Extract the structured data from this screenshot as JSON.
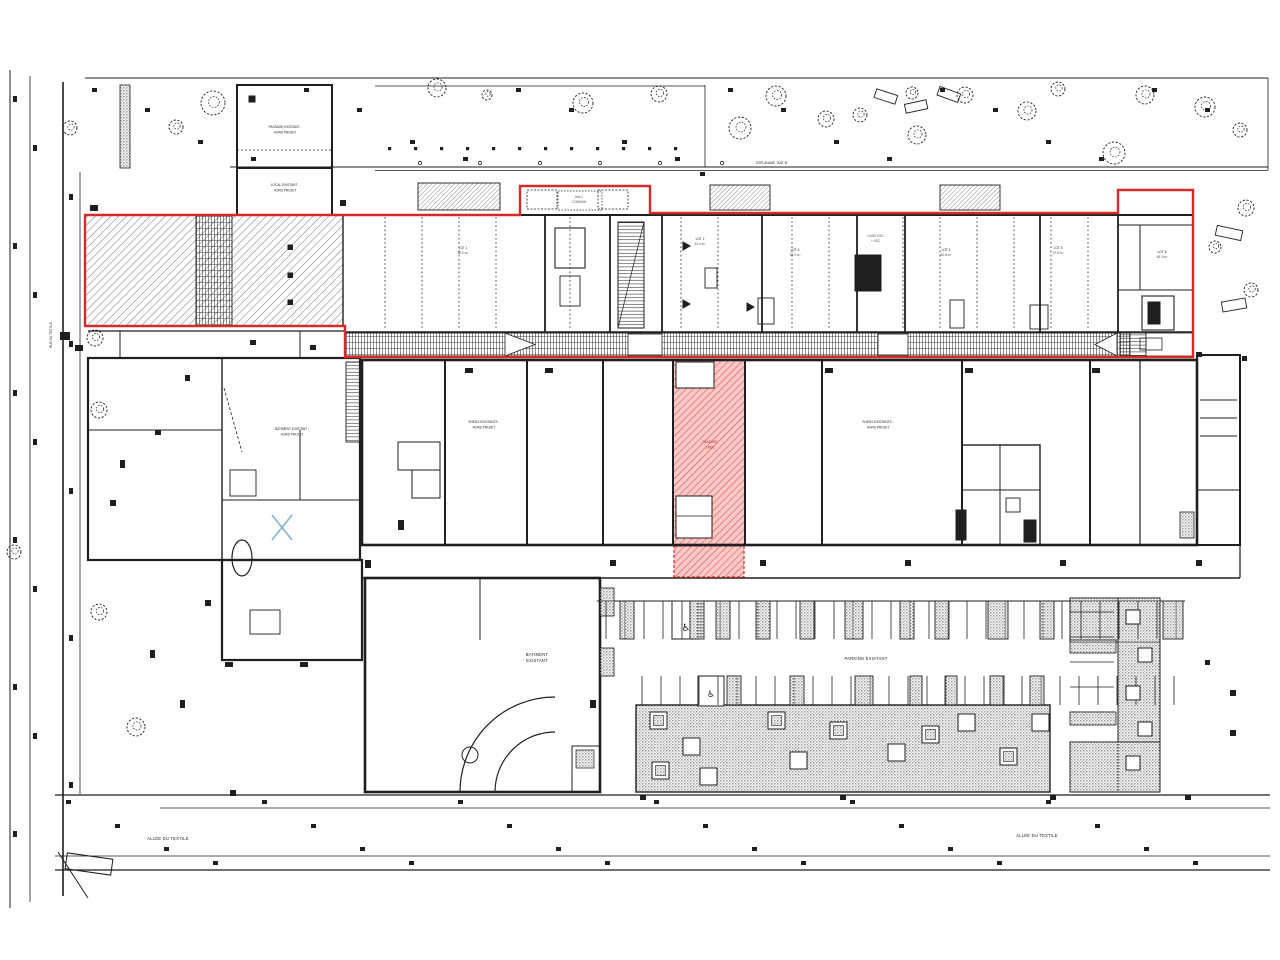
{
  "colors": {
    "ink": "#1f1f1f",
    "project_red": "#d32a2a",
    "zone_pink": "#f8c9c7",
    "hatch_red": "#dd4b4b",
    "cross_blue": "#7fb3d5",
    "hatch_gray": "#9a9a9a"
  },
  "labels": {
    "passage_existant": {
      "line1": "PASSAGE EXISTANT -",
      "line2": "HORS PROJET"
    },
    "local_existant": {
      "line1": "LOCAL EXISTANT -",
      "line2": "HORS PROJET"
    },
    "esplanade": "ESPLANADE \"AXE B\"",
    "batiment_existant_hp": {
      "line1": "BATIMENT EXISTANT -",
      "line2": "HORS PROJET"
    },
    "sheds_left": {
      "line1": "SHEDS EXISTANTS -",
      "line2": "HORS PROJET"
    },
    "sheds_right": {
      "line1": "SHEDS EXISTANTS -",
      "line2": "HORS PROJET"
    },
    "batiment_existant": {
      "line1": "BATIMENT",
      "line2": "EXISTANT"
    },
    "parking_existant": "PARKING EXISTANT",
    "allee_left": "ALLÉE DU TEXTILE",
    "allee_right": "ALLÉE DU TEXTILE",
    "rue_vertical": "RUE DU TEXTILE",
    "corridor": {
      "line1": "PASSAGE",
      "line2": "CRÉÉ"
    },
    "hall": {
      "line1": "HALL",
      "line2": "COMMUN"
    },
    "core": {
      "line1": "CAGE ESC.",
      "line2": "+ ASC."
    }
  },
  "units": [
    {
      "name": "LOT 1",
      "area": "58.2 m²"
    },
    {
      "name": "LOT 2",
      "area": "61.4 m²"
    },
    {
      "name": "LOT 3",
      "area": "35.0 m²"
    },
    {
      "name": "LOT 4",
      "area": "62.8 m²"
    },
    {
      "name": "LOT 5",
      "area": "57.6 m²"
    },
    {
      "name": "LOT 6",
      "area": "48.3 m²"
    }
  ],
  "icons": {
    "accessible_parking": "♿"
  }
}
